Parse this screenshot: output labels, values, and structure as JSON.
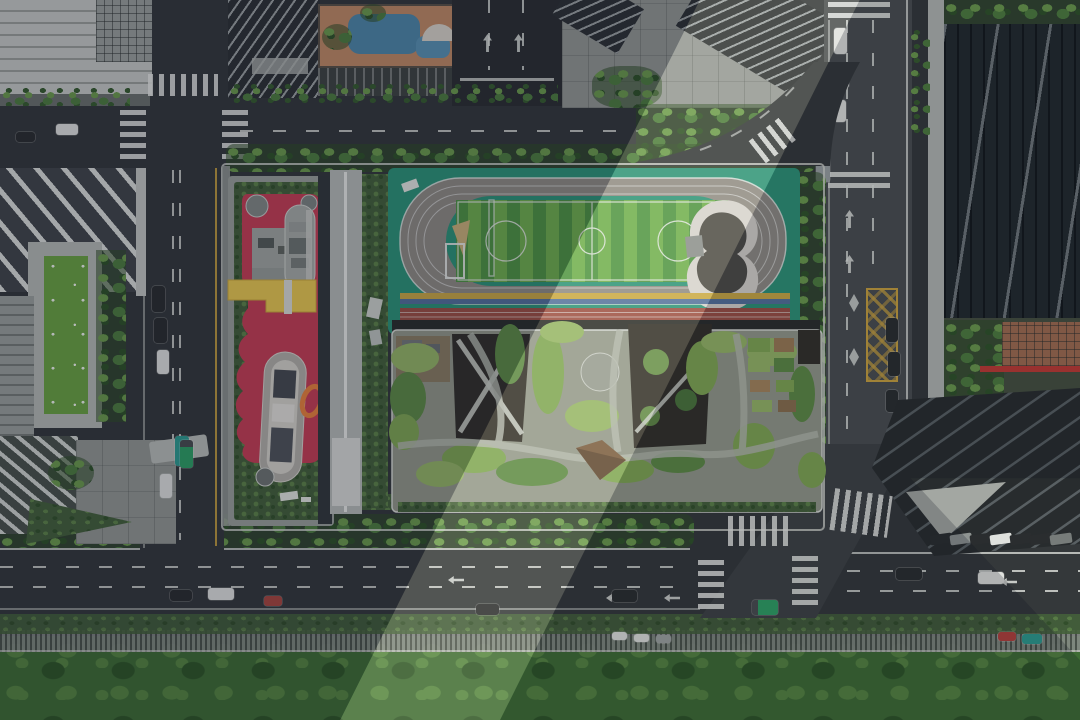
{
  "meta": {
    "image_type": "aerial-drone-photograph",
    "subject": "urban-school-campus",
    "width_px": 1080,
    "height_px": 720
  },
  "colors": {
    "asphalt": "#34383a",
    "asphalt_dark": "#2c2f31",
    "road_light": "#4a4e50",
    "sidewalk": "#6b706c",
    "plaza": "#939792",
    "bldg_light": "#c7cac5",
    "bldg_mid": "#9aa09c",
    "slab_dark": "#2d3134",
    "tower_dark": "#222a2d",
    "tower_band": "#6f767a",
    "glass_roof": "#b6bab6",
    "chevron_light": "#d9dcd8",
    "chevron_dark": "#41464a",
    "field_teal": "#2d9377",
    "track_gray": "#8f8b84",
    "pitch_a": "#6fae4e",
    "pitch_b": "#4f9443",
    "line_white": "#e8eae6",
    "lane_yellow": "#c9a845",
    "lane_blue": "#54719b",
    "lane_red": "#9c4f44",
    "sand": "#c9b078",
    "bowl_rim": "#d6d3cc",
    "bowl_pit": "#4e4c47",
    "red_court": "#c53e54",
    "yellow_canopy": "#e9c850",
    "orange_accent": "#e8823c",
    "roof_concrete": "#939889",
    "garden_a": "#7fa653",
    "garden_b": "#95b566",
    "garden_c": "#5d8a45",
    "pit_dark": "#33302a",
    "hedge": "#44603a",
    "tree_a": "#4e7d3e",
    "tree_b": "#6b9a4c",
    "park_a": "#3e6c34",
    "park_b": "#558540",
    "lawn": "#6aa342",
    "brick": "#a06c50",
    "red_wall": "#c03a34",
    "bus_teal": "#2e9b8f",
    "truck_green": "#2fa064",
    "car_white": "#dfe1dd",
    "car_dark": "#2a2d2f",
    "marking_yellow": "#c9a23e",
    "terrace_brown": "#8a7a5e",
    "capsule_gray": "#b3b0a8",
    "pavement_light": "#a3a7a2"
  },
  "scene": {
    "campus": {
      "sports_field": {
        "surface": "field_teal",
        "track": "track_gray",
        "pitch_stripes": [
          "pitch_a",
          "pitch_b"
        ],
        "sprint_lanes": [
          "lane_yellow",
          "lane_blue",
          "lane_red"
        ],
        "features": [
          "kidney-amphitheater",
          "sand-pit",
          "long-jump-frame",
          "soccer-markings"
        ]
      },
      "green_roof_building": {
        "roof": "roof_concrete",
        "gardens": [
          "garden_a",
          "garden_b",
          "garden_c"
        ],
        "courtyards": 3,
        "features": [
          "x-bridges",
          "round-plaza",
          "pitched-pavilion",
          "farm-plots",
          "winding-paths"
        ]
      },
      "red_playground_building": {
        "surface": "red_court",
        "canopy": "yellow_canopy",
        "rooftop_capsules": 2,
        "accents": [
          "orange_accent"
        ],
        "border": "hedge"
      },
      "greenhouse_strip": {
        "roof": "glass_roof"
      }
    },
    "roads": {
      "left_vertical_road": {
        "vehicles": [
          "car_dark",
          "car_dark",
          "car_white",
          "bus_teal",
          "car_white"
        ]
      },
      "top_horizontal_road": {
        "crosswalks": 3,
        "vehicles": [
          "car_white",
          "car_dark"
        ]
      },
      "right_vertical_road": {
        "features": [
          "yellow-hatch-box",
          "diamond-markings",
          "turn-arrows",
          "crosswalk"
        ],
        "vehicles": [
          "car_white",
          "car_white",
          "car_white",
          "car_dark",
          "car_dark",
          "car_dark"
        ]
      },
      "bottom_main_road": {
        "lanes": 3,
        "crosswalks": 4,
        "vehicles": [
          "car_dark",
          "car_dark",
          "car_white",
          "truck_green",
          "car_white"
        ]
      }
    },
    "surroundings": {
      "northwest": [
        "light-office-building",
        "chevron-roof-building",
        "lawn-terrace",
        "striped-facade-building",
        "corner-plaza"
      ],
      "north": [
        "louver-slab-buildings",
        "colorful-playground-podium",
        "light-plaza",
        "angled-slab-tower"
      ],
      "east": [
        "glass-tower-facade",
        "brick-courtyard",
        "ridged-roof-building",
        "parked-car-row"
      ],
      "south": [
        "street-tree-row",
        "bike-parking-strip",
        "city-park"
      ]
    },
    "lighting": {
      "tower_shadow_regions": 2,
      "sunlit_band_diagonal": true
    }
  }
}
